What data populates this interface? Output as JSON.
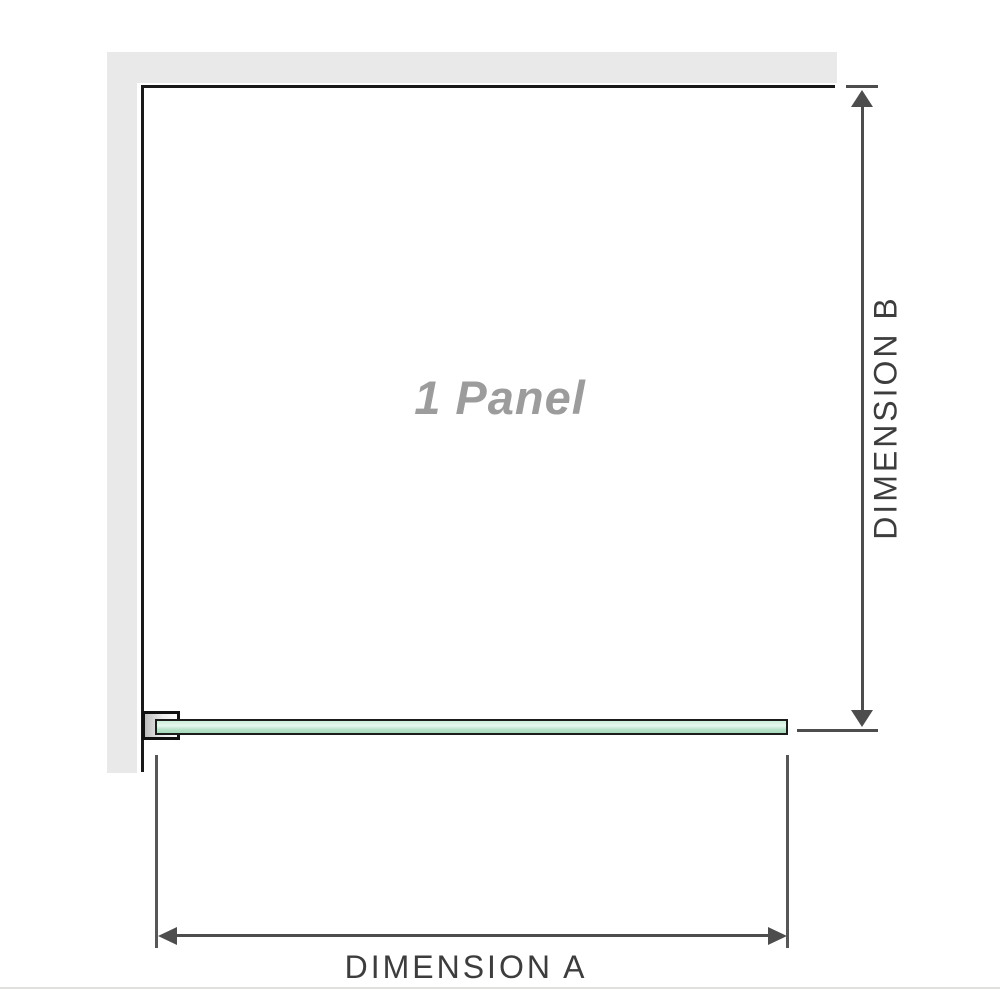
{
  "diagram": {
    "panel_label": "1 Panel",
    "dimension_a_label": "DIMENSION A",
    "dimension_b_label": "DIMENSION B",
    "colors": {
      "wall_fill": "#e9e9e9",
      "enclosure_outline": "#1a1a1a",
      "dimension_lines": "#4d4d4d",
      "dimension_text": "#3d3d3d",
      "panel_label_text": "#9c9c9c",
      "glass_fill": "#b7e2c9",
      "glass_highlight": "#e7f7ee",
      "glass_border": "#1c1c1c",
      "bracket_fill_gradient_start": "#bdbdbd",
      "page_divider": "#e0e0de"
    }
  }
}
